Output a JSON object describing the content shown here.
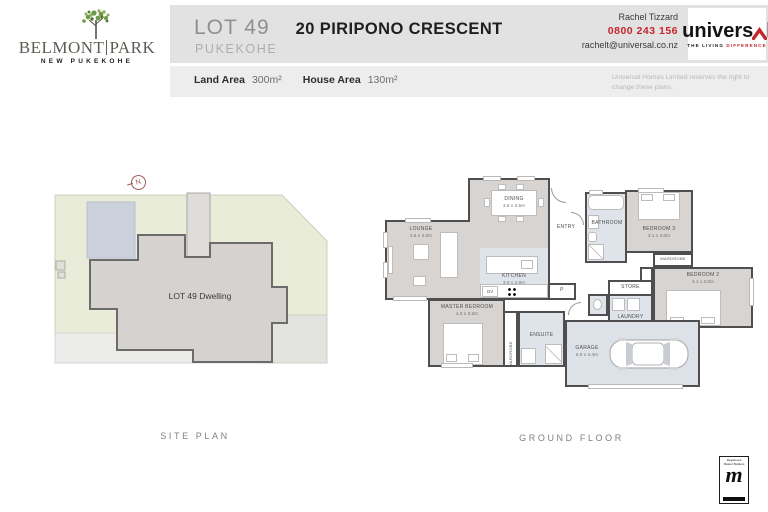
{
  "brand": {
    "name_left": "BELMONT",
    "name_right": "PARK",
    "subtitle": "NEW PUKEKOHE"
  },
  "header": {
    "lot": "LOT 49",
    "address": "20 PIRIPONO CRESCENT",
    "suburb": "PUKEKOHE",
    "agent_name": "Rachel Tizzard",
    "agent_phone": "0800 243 156",
    "agent_email": "rachelt@universal.co.nz",
    "logo_word_left": "univers",
    "logo_word_right": "l",
    "logo_tagline_left": "THE LIVING ",
    "logo_tagline_right": "DIFFERENCE",
    "land_area_label": "Land Area",
    "land_area_value": "300m²",
    "house_area_label": "House Area",
    "house_area_value": "130m²",
    "disclaimer": "Universal Homes Limited reserves the right to change these plans."
  },
  "site_plan": {
    "caption": "SITE PLAN",
    "dwelling_label": "LOT 49 Dwelling",
    "north": "N"
  },
  "floor_plan": {
    "caption": "GROUND FLOOR",
    "rooms": {
      "lounge": {
        "name": "LOUNGE",
        "dims": "4.6 x 4.0m"
      },
      "dining": {
        "name": "DINING",
        "dims": "3.6 x 3.5m"
      },
      "kitchen": {
        "name": "KITCHEN",
        "dims": "3.0 x 2.8m"
      },
      "entry": {
        "name": "ENTRY"
      },
      "bathroom": {
        "name": "BATHROOM"
      },
      "bedroom3": {
        "name": "BEDROOM 3",
        "dims": "3.1 x 3.0m"
      },
      "bedroom2": {
        "name": "BEDROOM 2",
        "dims": "3.1 x 3.0m"
      },
      "master": {
        "name": "MASTER BEDROOM",
        "dims": "4.0 x 3.2m"
      },
      "ensuite": {
        "name": "ENSUITE"
      },
      "garage": {
        "name": "GARAGE",
        "dims": "6.0 x 4.4m"
      },
      "store": {
        "name": "STORE"
      },
      "laundry": {
        "name": "LAUNDRY"
      },
      "wardrobe": {
        "name": "WARDROBE"
      },
      "oven": {
        "name": "OV"
      },
      "pantry": {
        "name": "P"
      }
    }
  },
  "badge": {
    "line1": "Registered",
    "line2": "Master Builders",
    "glyph": "m"
  },
  "colors": {
    "accent_red": "#c4262e",
    "band": "#e2e2e2",
    "band_light": "#ededed",
    "floor": "#d8d4d1",
    "wet_floor": "#dfe4ea",
    "wall": "#4f4f4f",
    "site_green": "#e9ecd8",
    "site_blue": "#cbd2dd",
    "dwelling": "#d6d2cf"
  }
}
